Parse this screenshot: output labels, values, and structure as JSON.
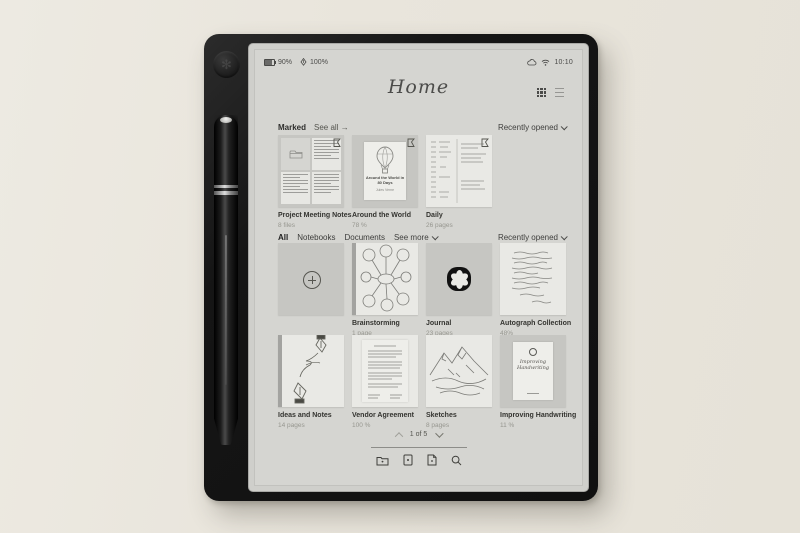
{
  "colors": {
    "background": "#e9e5dc",
    "device": "#151515",
    "screen": "#d5d5d1",
    "text_primary": "#3b3b39",
    "text_secondary": "#96968f"
  },
  "status_bar": {
    "battery_level": "90%",
    "pen_level": "100%",
    "time": "10:10",
    "icons": [
      "battery-icon",
      "stylus-icon",
      "cloud-icon",
      "wifi-icon"
    ]
  },
  "header": {
    "title": "Home",
    "view_icons": [
      "grid-view-icon",
      "list-view-icon"
    ]
  },
  "marked_section": {
    "title": "Marked",
    "see_all_label": "See all →",
    "sort_label": "Recently opened",
    "items": [
      {
        "name": "Project Meeting Notes",
        "meta": "8 files"
      },
      {
        "name": "Around the World",
        "meta": "78 %"
      },
      {
        "name": "Daily",
        "meta": "26 pages"
      }
    ]
  },
  "library_section": {
    "tabs": [
      {
        "label": "All",
        "active": true
      },
      {
        "label": "Notebooks",
        "active": false
      },
      {
        "label": "Documents",
        "active": false
      }
    ],
    "see_more_label": "See more",
    "sort_label": "Recently opened",
    "items": [
      {
        "name": "Brainstorming",
        "meta": "1 page"
      },
      {
        "name": "Journal",
        "meta": "23 pages"
      },
      {
        "name": "Autograph Collection",
        "meta": "48%"
      },
      {
        "name": "Ideas and Notes",
        "meta": "14 pages"
      },
      {
        "name": "Vendor Agreement",
        "meta": "100 %"
      },
      {
        "name": "Sketches",
        "meta": "8 pages"
      },
      {
        "name": "Improving Handwriting",
        "meta": "11 %"
      }
    ]
  },
  "covers": {
    "around_the_world": {
      "title": "Around the World in 80 Days",
      "author": "Jules Verne"
    },
    "improving_handwriting": {
      "title": "Improving Handwriting"
    }
  },
  "pagination": {
    "label": "1 of 5",
    "prev_icon": "chevron-up-icon",
    "next_icon": "chevron-down-icon"
  },
  "toolbar": {
    "icons": [
      "folder-icon",
      "import-document-icon",
      "new-document-icon",
      "search-icon"
    ]
  }
}
